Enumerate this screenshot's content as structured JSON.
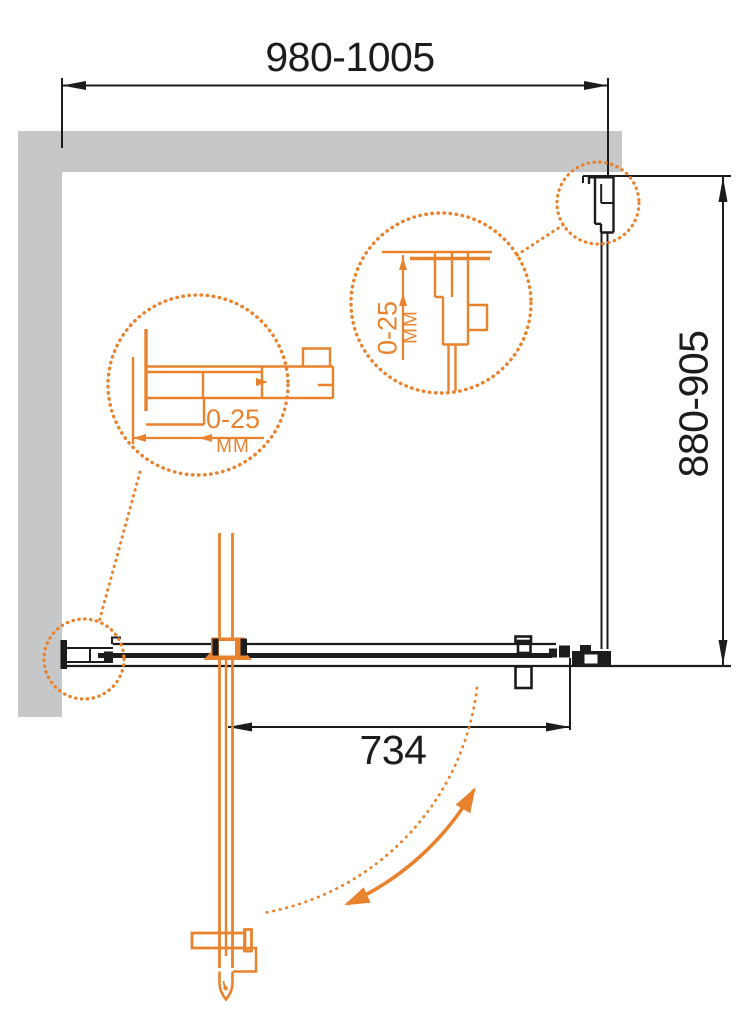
{
  "diagram": {
    "kind": "shower-enclosure-installation-plan",
    "dim_top_width": "980-1005",
    "dim_side_depth": "880-905",
    "dim_door_opening": "734",
    "callout_left": {
      "range": "0-25",
      "unit": "ММ"
    },
    "callout_middle": {
      "range": "0-25",
      "unit": "ММ"
    }
  },
  "colors": {
    "accent_orange": "#E8822D",
    "wall_gray": "#C5C7C9",
    "line_black": "#1C1C1C",
    "background": "#FFFFFF"
  }
}
